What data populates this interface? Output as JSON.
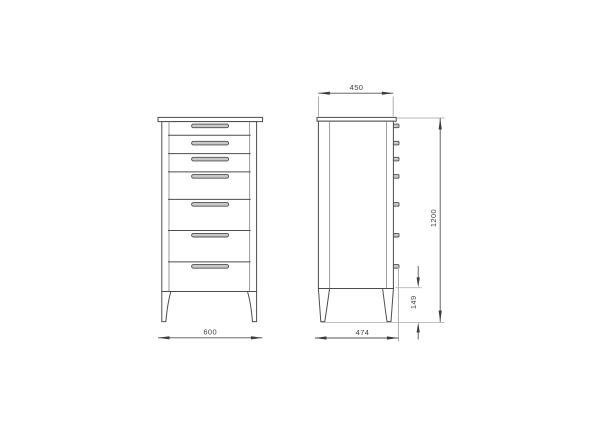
{
  "drawing": {
    "kind": "furniture dimensional drawing",
    "subject": "tall chest of drawers shown in front and side elevation",
    "views": [
      {
        "id": "front",
        "description": "front elevation with 7 drawers and centered handles"
      },
      {
        "id": "side",
        "description": "side elevation with 7 protruding handle profiles"
      }
    ],
    "structure": {
      "drawer_count": 7,
      "handle_count": 7,
      "leg_count_visible_per_view": 2
    },
    "dimensions": {
      "front_width": {
        "label": "600",
        "placement": "below front view"
      },
      "top_depth": {
        "label": "450",
        "placement": "above side view"
      },
      "bottom_depth": {
        "label": "474",
        "placement": "below side view"
      },
      "overall_height": {
        "label": "1200",
        "placement": "right of side view, rotated"
      },
      "leg_height": {
        "label": "149",
        "placement": "right of side view legs, rotated"
      }
    },
    "colors": {
      "background": "#ffffff",
      "outline": "#4d4d4d",
      "inner_line": "#8f8f8f",
      "handle_fill": "#c8c8c8",
      "dimension_line": "#565656",
      "extension_line": "#b6b6b6",
      "text": "#3f3f3f"
    }
  }
}
